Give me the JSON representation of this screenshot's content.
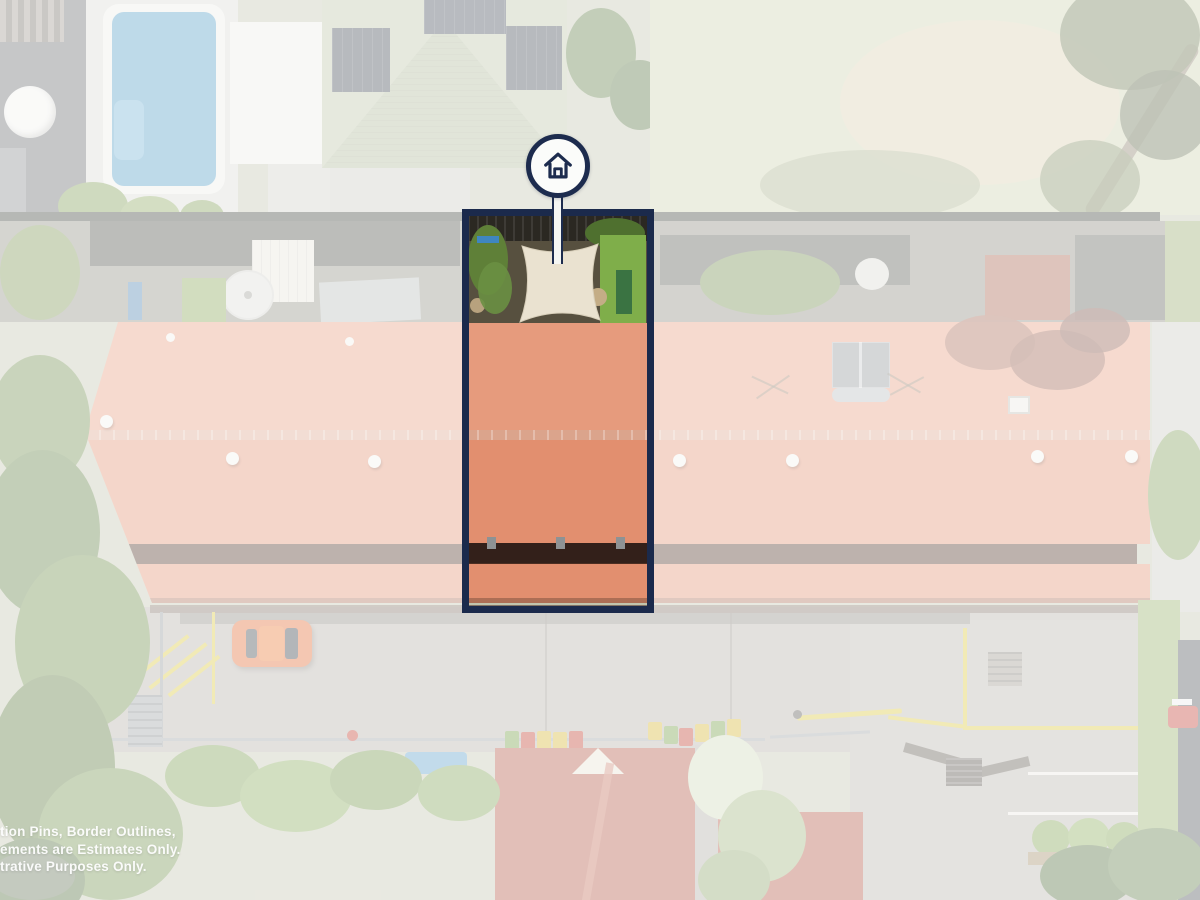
{
  "disclaimer": {
    "lines": [
      "tion Pins, Border Outlines,",
      "ements are Estimates Only.",
      "trative Purposes Only."
    ],
    "color": "#ffffff"
  },
  "marker": {
    "icon": "house-icon",
    "circle_fill": "#fbfcfa",
    "outline_color": "#1d2c4e"
  },
  "lot_highlight": {
    "border_color": "#1b2a4c",
    "wash_color": "rgba(255,255,255,0.63)"
  },
  "palette": {
    "navy": "#1d2c4e",
    "roof_terracotta": "#e28f6f",
    "roof_ridge": "#dba48c",
    "roof_dark_stripe": "#4c2e22",
    "pool_blue": "#4f9ac4",
    "car_orange": "#e2672f",
    "grass_green": "#6d8c4a",
    "sail_cream": "#eae2d0",
    "asphalt_grey": "#b3aea6",
    "brick_red": "#b1533e",
    "line_yellow": "#d9c53b"
  }
}
